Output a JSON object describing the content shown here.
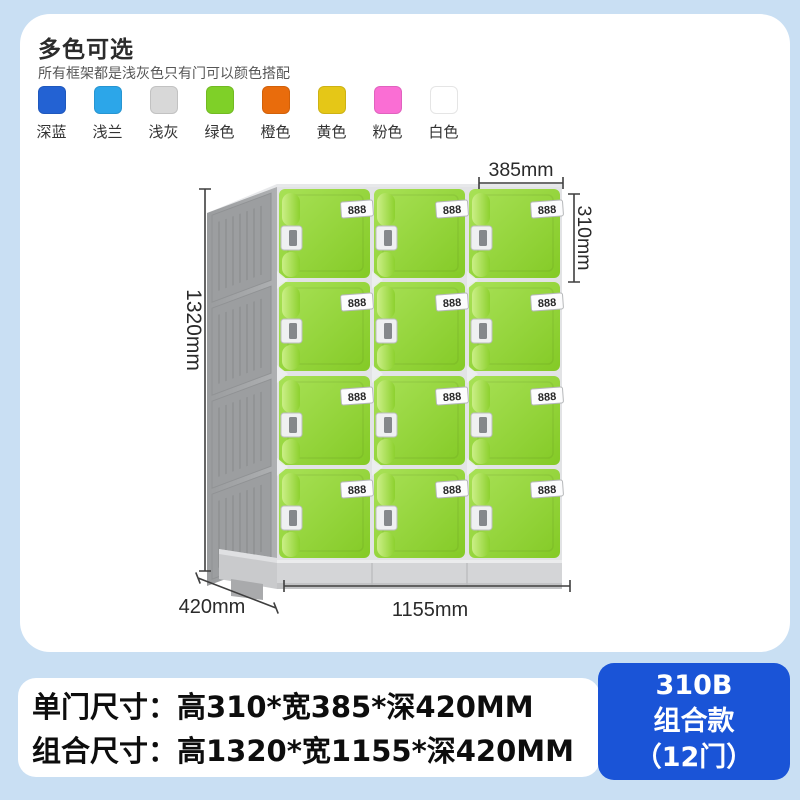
{
  "page": {
    "background": "#c9dff3"
  },
  "color_section": {
    "title": "多色可选",
    "subtitle": "所有框架都是浅灰色只有门可以颜色搭配",
    "swatches": [
      {
        "label": "深蓝",
        "color": "#2362d3"
      },
      {
        "label": "浅兰",
        "color": "#2ca6e9"
      },
      {
        "label": "浅灰",
        "color": "#d8d8d8"
      },
      {
        "label": "绿色",
        "color": "#7fd028"
      },
      {
        "label": "橙色",
        "color": "#e96c0c"
      },
      {
        "label": "黄色",
        "color": "#e5c717"
      },
      {
        "label": "粉色",
        "color": "#fa6ed4"
      },
      {
        "label": "白色",
        "color": "#ffffff"
      }
    ]
  },
  "locker": {
    "lock_label": "888",
    "door_color": "#93d636",
    "frame_color": "#a4a6a8",
    "dimensions": {
      "door_width": "385mm",
      "door_height": "310mm",
      "total_height": "1320mm",
      "depth": "420mm",
      "total_width": "1155mm"
    }
  },
  "specs": {
    "line1": "单门尺寸：高310*宽385*深420MM",
    "line2": "组合尺寸：高1320*宽1155*深420MM"
  },
  "badge": {
    "model": "310B",
    "series": "组合款",
    "doors": "（12门）",
    "color": "#1a54d7"
  }
}
